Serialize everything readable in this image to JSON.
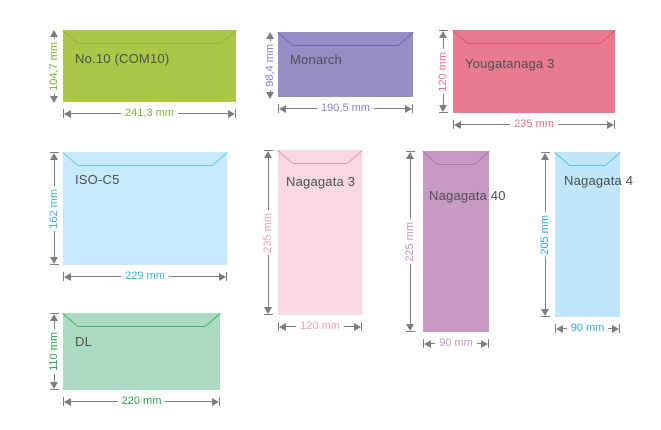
{
  "diagram": {
    "subject": "Envelope size specifications"
  },
  "label_color": "#4d4d4d",
  "line_color": "#7d7d7d",
  "figures": [
    {
      "name": "No.10 (COM10)",
      "height_label": "104,7 mm",
      "width_label": "241,3 mm",
      "colors": {
        "fill": "#a9c848",
        "flap": "#8eb837",
        "dimension_text": "#79b334"
      }
    },
    {
      "name": "Monarch",
      "height_label": "98,4 mm",
      "width_label": "190,5 mm",
      "colors": {
        "fill": "#968dc6",
        "flap": "#7166b0",
        "dimension_text": "#8a80c3"
      }
    },
    {
      "name": "Yougatanaga 3",
      "height_label": "120 mm",
      "width_label": "235 mm",
      "colors": {
        "fill": "#e87b90",
        "flap": "#e2506e",
        "dimension_text": "#ec7088"
      }
    },
    {
      "name": "ISO-C5",
      "height_label": "162 mm",
      "width_label": "229 mm",
      "colors": {
        "fill": "#c6eafc",
        "flap": "#62c7f1",
        "dimension_text": "#3ab2e8"
      }
    },
    {
      "name": "Nagagata 3",
      "height_label": "235 mm",
      "width_label": "120 mm",
      "colors": {
        "fill": "#f8d8e5",
        "flap": "#f08ea5",
        "dimension_text": "#f3a0bb"
      }
    },
    {
      "name": "Nagagata 40",
      "height_label": "225 mm",
      "width_label": "90 mm",
      "colors": {
        "fill": "#c999c5",
        "flap": "#ac73a8",
        "dimension_text": "#c795c3"
      }
    },
    {
      "name": "Nagagata 4",
      "height_label": "205 mm",
      "width_label": "90 mm",
      "colors": {
        "fill": "#c0e6fa",
        "flap": "#52bfee",
        "dimension_text": "#2eaae0"
      }
    },
    {
      "name": "DL",
      "height_label": "110 mm",
      "width_label": "220 mm",
      "colors": {
        "fill": "#abdcc3",
        "flap": "#42b44b",
        "dimension_text": "#27a349"
      }
    }
  ]
}
